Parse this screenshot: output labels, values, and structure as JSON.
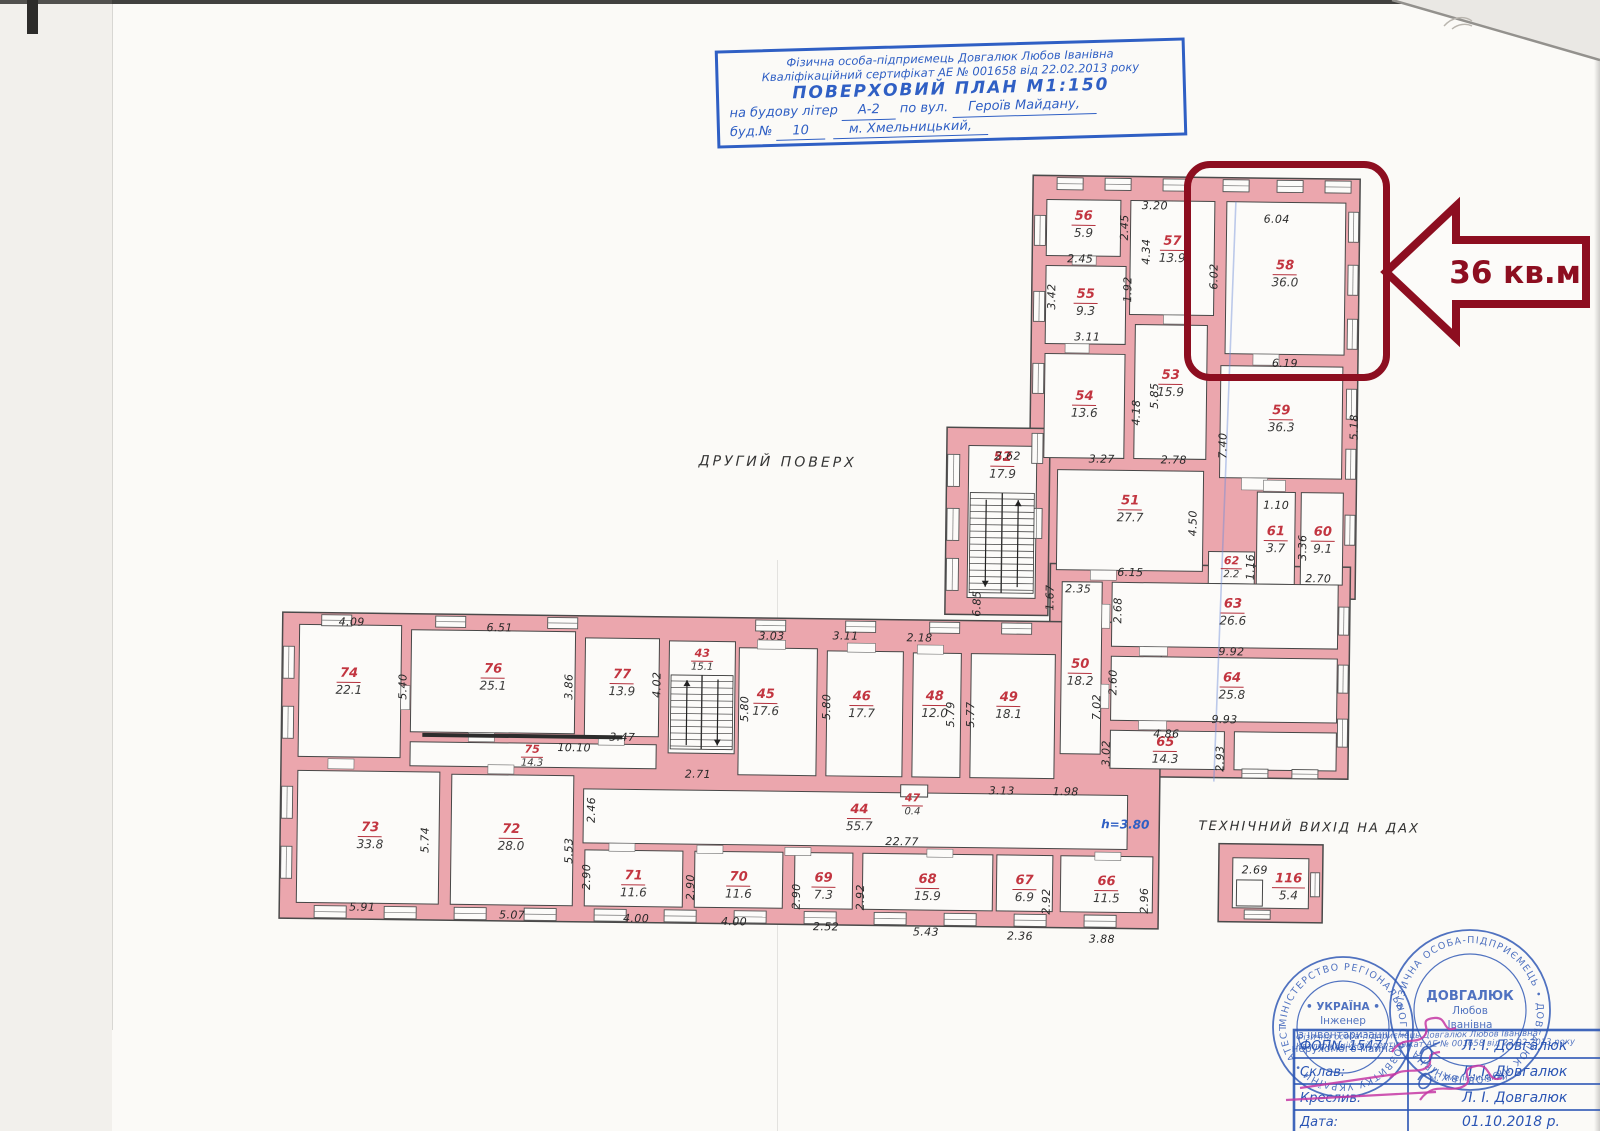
{
  "title_block": {
    "line1": "Фізична особа-підприємець Довгалюк Любов Іванівна",
    "line2": "Кваліфікаційний сертифікат АЕ № 001658 від 22.02.2013 року",
    "line3": "ПОВЕРХОВИЙ ПЛАН   М1:150",
    "line4_prefix": "на будову літер",
    "line4_value": "А-2",
    "line4_mid": "по вул.",
    "line4_street": "Героїв Майдану,",
    "line5_prefix": "буд.№",
    "line5_value": "10",
    "line5_city": "м. Хмельницький,"
  },
  "plan": {
    "floor_label": "ДРУГИЙ ПОВЕРХ",
    "tech_exit_label": "ТЕХНІЧНИЙ ВИХІД НА ДАХ",
    "height_note": "h=3.80",
    "rooms": [
      {
        "num": "56",
        "area": "5.9"
      },
      {
        "num": "57",
        "area": "13.9"
      },
      {
        "num": "55",
        "area": "9.3"
      },
      {
        "num": "58",
        "area": "36.0"
      },
      {
        "num": "53",
        "area": "15.9"
      },
      {
        "num": "54",
        "area": "13.6"
      },
      {
        "num": "52",
        "area": "17.9"
      },
      {
        "num": "59",
        "area": "36.3"
      },
      {
        "num": "51",
        "area": "27.7"
      },
      {
        "num": "61",
        "area": "3.7"
      },
      {
        "num": "60",
        "area": "9.1"
      },
      {
        "num": "62",
        "area": "2.2"
      },
      {
        "num": "63",
        "area": "26.6"
      },
      {
        "num": "50",
        "area": "18.2"
      },
      {
        "num": "64",
        "area": "25.8"
      },
      {
        "num": "65",
        "area": "14.3"
      },
      {
        "num": "74",
        "area": "22.1"
      },
      {
        "num": "76",
        "area": "25.1"
      },
      {
        "num": "77",
        "area": "13.9"
      },
      {
        "num": "43",
        "area": "15.1"
      },
      {
        "num": "75",
        "area": "14.3"
      },
      {
        "num": "45",
        "area": "17.6"
      },
      {
        "num": "46",
        "area": "17.7"
      },
      {
        "num": "48",
        "area": "12.0"
      },
      {
        "num": "49",
        "area": "18.1"
      },
      {
        "num": "44",
        "area": "55.7"
      },
      {
        "num": "47",
        "area": "0.4"
      },
      {
        "num": "73",
        "area": "33.8"
      },
      {
        "num": "72",
        "area": "28.0"
      },
      {
        "num": "71",
        "area": "11.6"
      },
      {
        "num": "70",
        "area": "11.6"
      },
      {
        "num": "69",
        "area": "7.3"
      },
      {
        "num": "68",
        "area": "15.9"
      },
      {
        "num": "67",
        "area": "6.9"
      },
      {
        "num": "66",
        "area": "11.5"
      },
      {
        "num": "116",
        "area": "5.4"
      }
    ],
    "dimensions": [
      {
        "t": "3.20",
        "x": 1150,
        "y": 201
      },
      {
        "t": "6.04",
        "x": 1272,
        "y": 213
      },
      {
        "t": "2.45",
        "x": 1076,
        "y": 255
      },
      {
        "t": "3.11",
        "x": 1084,
        "y": 333
      },
      {
        "t": "2.62",
        "x": 1006,
        "y": 453
      },
      {
        "t": "3.27",
        "x": 1100,
        "y": 455
      },
      {
        "t": "2.78",
        "x": 1172,
        "y": 455
      },
      {
        "t": "6.19",
        "x": 1282,
        "y": 357
      },
      {
        "t": "1.10",
        "x": 1275,
        "y": 499
      },
      {
        "t": "2.70",
        "x": 1318,
        "y": 572
      },
      {
        "t": "6.15",
        "x": 1130,
        "y": 568
      },
      {
        "t": "2.35",
        "x": 1078,
        "y": 585
      },
      {
        "t": "9.92",
        "x": 1232,
        "y": 646
      },
      {
        "t": "9.93",
        "x": 1226,
        "y": 714
      },
      {
        "t": "4.86",
        "x": 1168,
        "y": 729
      },
      {
        "t": "3.13",
        "x": 1004,
        "y": 788
      },
      {
        "t": "1.98",
        "x": 1068,
        "y": 788
      },
      {
        "t": "4.09",
        "x": 352,
        "y": 627
      },
      {
        "t": "6.51",
        "x": 500,
        "y": 631
      },
      {
        "t": "3.03",
        "x": 772,
        "y": 636
      },
      {
        "t": "3.11",
        "x": 846,
        "y": 635
      },
      {
        "t": "2.18",
        "x": 920,
        "y": 636
      },
      {
        "t": "3.47",
        "x": 624,
        "y": 739
      },
      {
        "t": "10.10",
        "x": 576,
        "y": 750
      },
      {
        "t": "2.71",
        "x": 700,
        "y": 775
      },
      {
        "t": "22.77",
        "x": 905,
        "y": 840
      },
      {
        "t": "5.91",
        "x": 366,
        "y": 912
      },
      {
        "t": "5.07",
        "x": 516,
        "y": 918
      },
      {
        "t": "4.00",
        "x": 640,
        "y": 920
      },
      {
        "t": "4.00",
        "x": 738,
        "y": 922
      },
      {
        "t": "2.52",
        "x": 830,
        "y": 926
      },
      {
        "t": "5.43",
        "x": 930,
        "y": 930
      },
      {
        "t": "2.36",
        "x": 1024,
        "y": 933
      },
      {
        "t": "3.88",
        "x": 1106,
        "y": 935
      },
      {
        "t": "2.69",
        "x": 1258,
        "y": 864
      },
      {
        "t": "2.45",
        "x": 1120,
        "y": 223,
        "v": 1
      },
      {
        "t": "4.34",
        "x": 1142,
        "y": 247,
        "v": 1
      },
      {
        "t": "1.92",
        "x": 1124,
        "y": 285,
        "v": 1
      },
      {
        "t": "3.42",
        "x": 1048,
        "y": 293,
        "v": 1
      },
      {
        "t": "6.02",
        "x": 1210,
        "y": 271,
        "v": 1
      },
      {
        "t": "5.85",
        "x": 1152,
        "y": 391,
        "v": 1
      },
      {
        "t": "4.18",
        "x": 1134,
        "y": 408,
        "v": 1
      },
      {
        "t": "7.40",
        "x": 1221,
        "y": 440,
        "v": 1
      },
      {
        "t": "5.18",
        "x": 1352,
        "y": 420,
        "v": 1
      },
      {
        "t": "4.50",
        "x": 1192,
        "y": 518,
        "v": 1
      },
      {
        "t": "3.36",
        "x": 1302,
        "y": 541,
        "v": 1
      },
      {
        "t": "1.16",
        "x": 1250,
        "y": 561,
        "v": 1
      },
      {
        "t": "1.67",
        "x": 1050,
        "y": 594,
        "v": 1
      },
      {
        "t": "2.68",
        "x": 1118,
        "y": 606,
        "v": 1
      },
      {
        "t": "2.60",
        "x": 1114,
        "y": 678,
        "v": 1
      },
      {
        "t": "7.02",
        "x": 1098,
        "y": 703,
        "v": 1
      },
      {
        "t": "3.02",
        "x": 1108,
        "y": 749,
        "v": 1
      },
      {
        "t": "2.93",
        "x": 1222,
        "y": 753,
        "v": 1
      },
      {
        "t": "6.85",
        "x": 977,
        "y": 601,
        "v": 1
      },
      {
        "t": "5.40",
        "x": 404,
        "y": 691,
        "v": 1
      },
      {
        "t": "3.86",
        "x": 570,
        "y": 689,
        "v": 1
      },
      {
        "t": "4.02",
        "x": 658,
        "y": 686,
        "v": 1
      },
      {
        "t": "5.80",
        "x": 746,
        "y": 709,
        "v": 1
      },
      {
        "t": "5.80",
        "x": 828,
        "y": 706,
        "v": 1
      },
      {
        "t": "5.79",
        "x": 952,
        "y": 712,
        "v": 1
      },
      {
        "t": "5.77",
        "x": 972,
        "y": 712,
        "v": 1
      },
      {
        "t": "5.74",
        "x": 428,
        "y": 844,
        "v": 1
      },
      {
        "t": "5.53",
        "x": 572,
        "y": 853,
        "v": 1
      },
      {
        "t": "2.46",
        "x": 594,
        "y": 812,
        "v": 1
      },
      {
        "t": "2.90",
        "x": 590,
        "y": 879,
        "v": 1
      },
      {
        "t": "2.90",
        "x": 694,
        "y": 888,
        "v": 1
      },
      {
        "t": "2.90",
        "x": 800,
        "y": 896,
        "v": 1
      },
      {
        "t": "2.92",
        "x": 864,
        "y": 896,
        "v": 1
      },
      {
        "t": "2.92",
        "x": 1050,
        "y": 898,
        "v": 1
      },
      {
        "t": "2.96",
        "x": 1148,
        "y": 896,
        "v": 1
      }
    ]
  },
  "highlight": {
    "label": "36 кв.м."
  },
  "stamps": {
    "round1": {
      "ring": "МІНІСТЕРСТВО РЕГІОНАЛЬНОГО РОЗВИТКУ УКРАЇНИ • АТЕСТАЦІЙНА АРХІТЕКТУРНО-БУДІВЕЛЬНА КОМІСІЯ •",
      "center": [
        "• УКРАЇНА •",
        "Інженер",
        "з інвентаризації",
        "нерухомого майна"
      ]
    },
    "round2": {
      "ring": "ФІЗИЧНА ОСОБА-ПІДПРИЄМЕЦЬ • ДОВГАЛЮК ЛЮБОВ ІВАНІВНА •",
      "center": [
        "ДОВГАЛЮК",
        "Любов",
        "Іванівна"
      ]
    },
    "overprint": [
      "Фізична особа-підприємець Довгалюк Любов Іванівна",
      "Кваліфікаційний сертифікат АЕ № 001658 від 22.02.2013 року",
      "м. Хмельницький"
    ],
    "table": {
      "rows": [
        {
          "label": "ФОП№ 1547",
          "value": "Л. І. Довгалюк"
        },
        {
          "label": "Склав:",
          "value": "Л. І. Довгалюк"
        },
        {
          "label": "Креслив:",
          "value": "Л. І. Довгалюк"
        },
        {
          "label": "Дата:",
          "value": "01.10.2018 р."
        }
      ]
    }
  },
  "colors": {
    "wall_pink": "#eba6ad",
    "room_number_red": "#c23540",
    "highlight_red": "#8d0e20",
    "stamp_blue": "#2b55b4",
    "title_blue": "#2f5fc4",
    "signature_magenta": "#c437a5"
  }
}
